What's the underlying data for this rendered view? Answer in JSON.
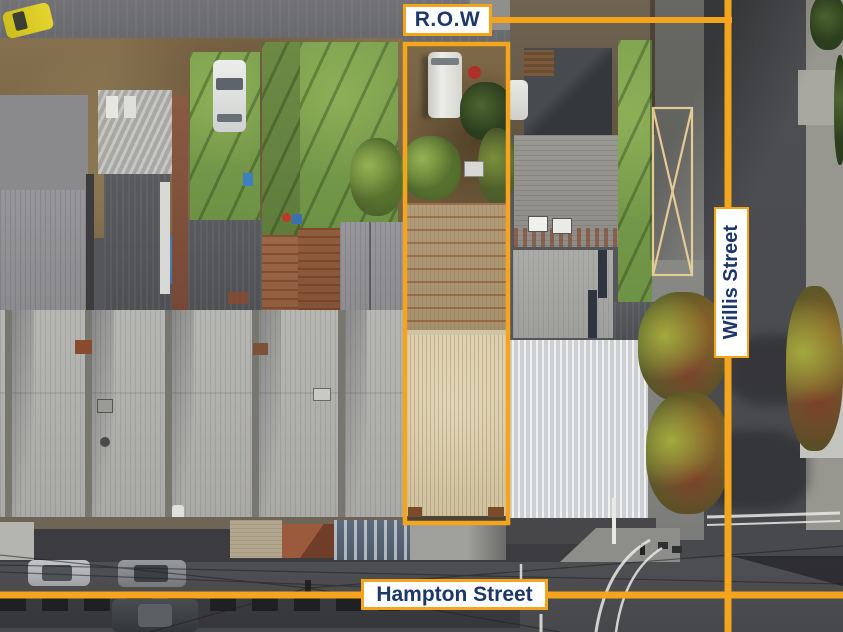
{
  "annotations": {
    "row_label": "R.O.W",
    "willis_street": "Willis Street",
    "hampton_street": "Hampton Street"
  },
  "colors": {
    "annotation_orange": "#F4A41D",
    "label_text": "#1C3769",
    "label_background": "#FFFFFF",
    "hatch_line": "#EBD096"
  }
}
